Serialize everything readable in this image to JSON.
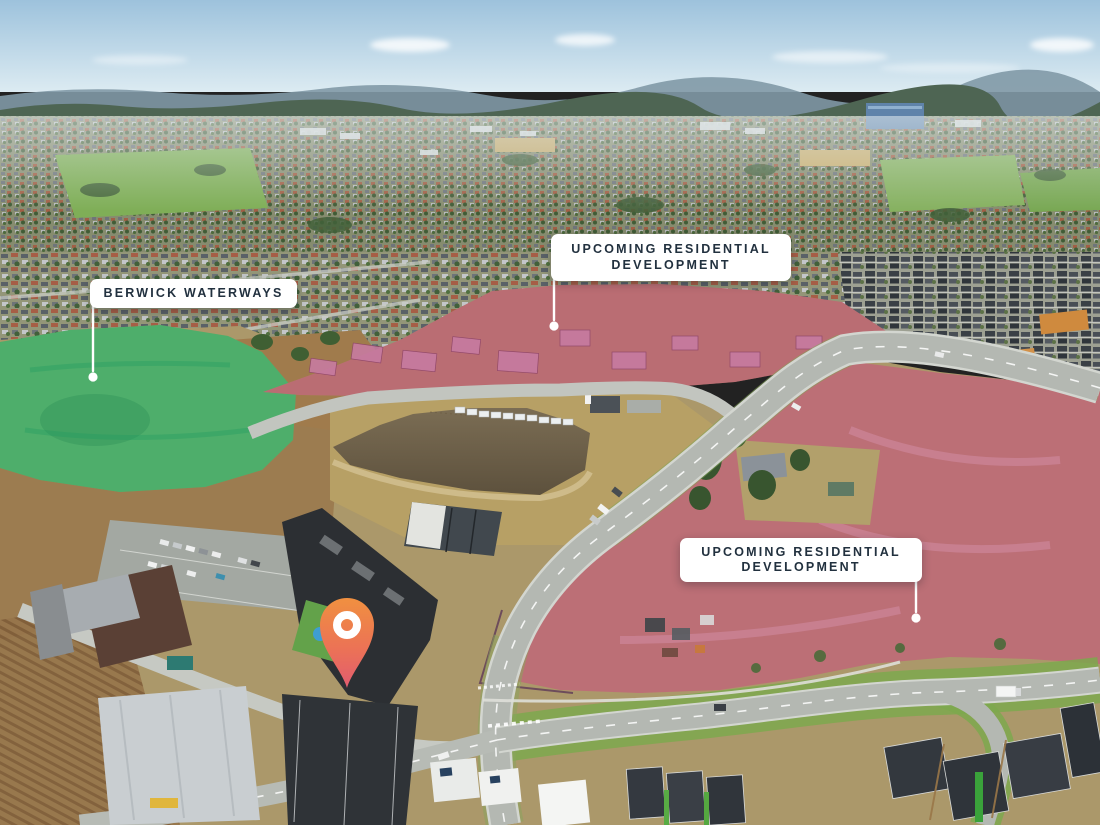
{
  "annotations": {
    "berwick_waterways": {
      "label": "BERWICK WATERWAYS"
    },
    "development_north": {
      "label": "UPCOMING RESIDENTIAL DEVELOPMENT"
    },
    "development_east": {
      "label": "UPCOMING RESIDENTIAL DEVELOPMENT"
    }
  },
  "markers": {
    "location_pin": {
      "type": "map-pin"
    }
  },
  "colors": {
    "label_background": "#ffffff",
    "label_text": "#22313f",
    "leader_line": "#ffffff",
    "overlay_green": "#2eb274",
    "overlay_pink": "#c2497e",
    "pin_gradient_top": "#f09040",
    "pin_gradient_bottom": "#e25c70",
    "pin_ring": "#ffffff"
  }
}
